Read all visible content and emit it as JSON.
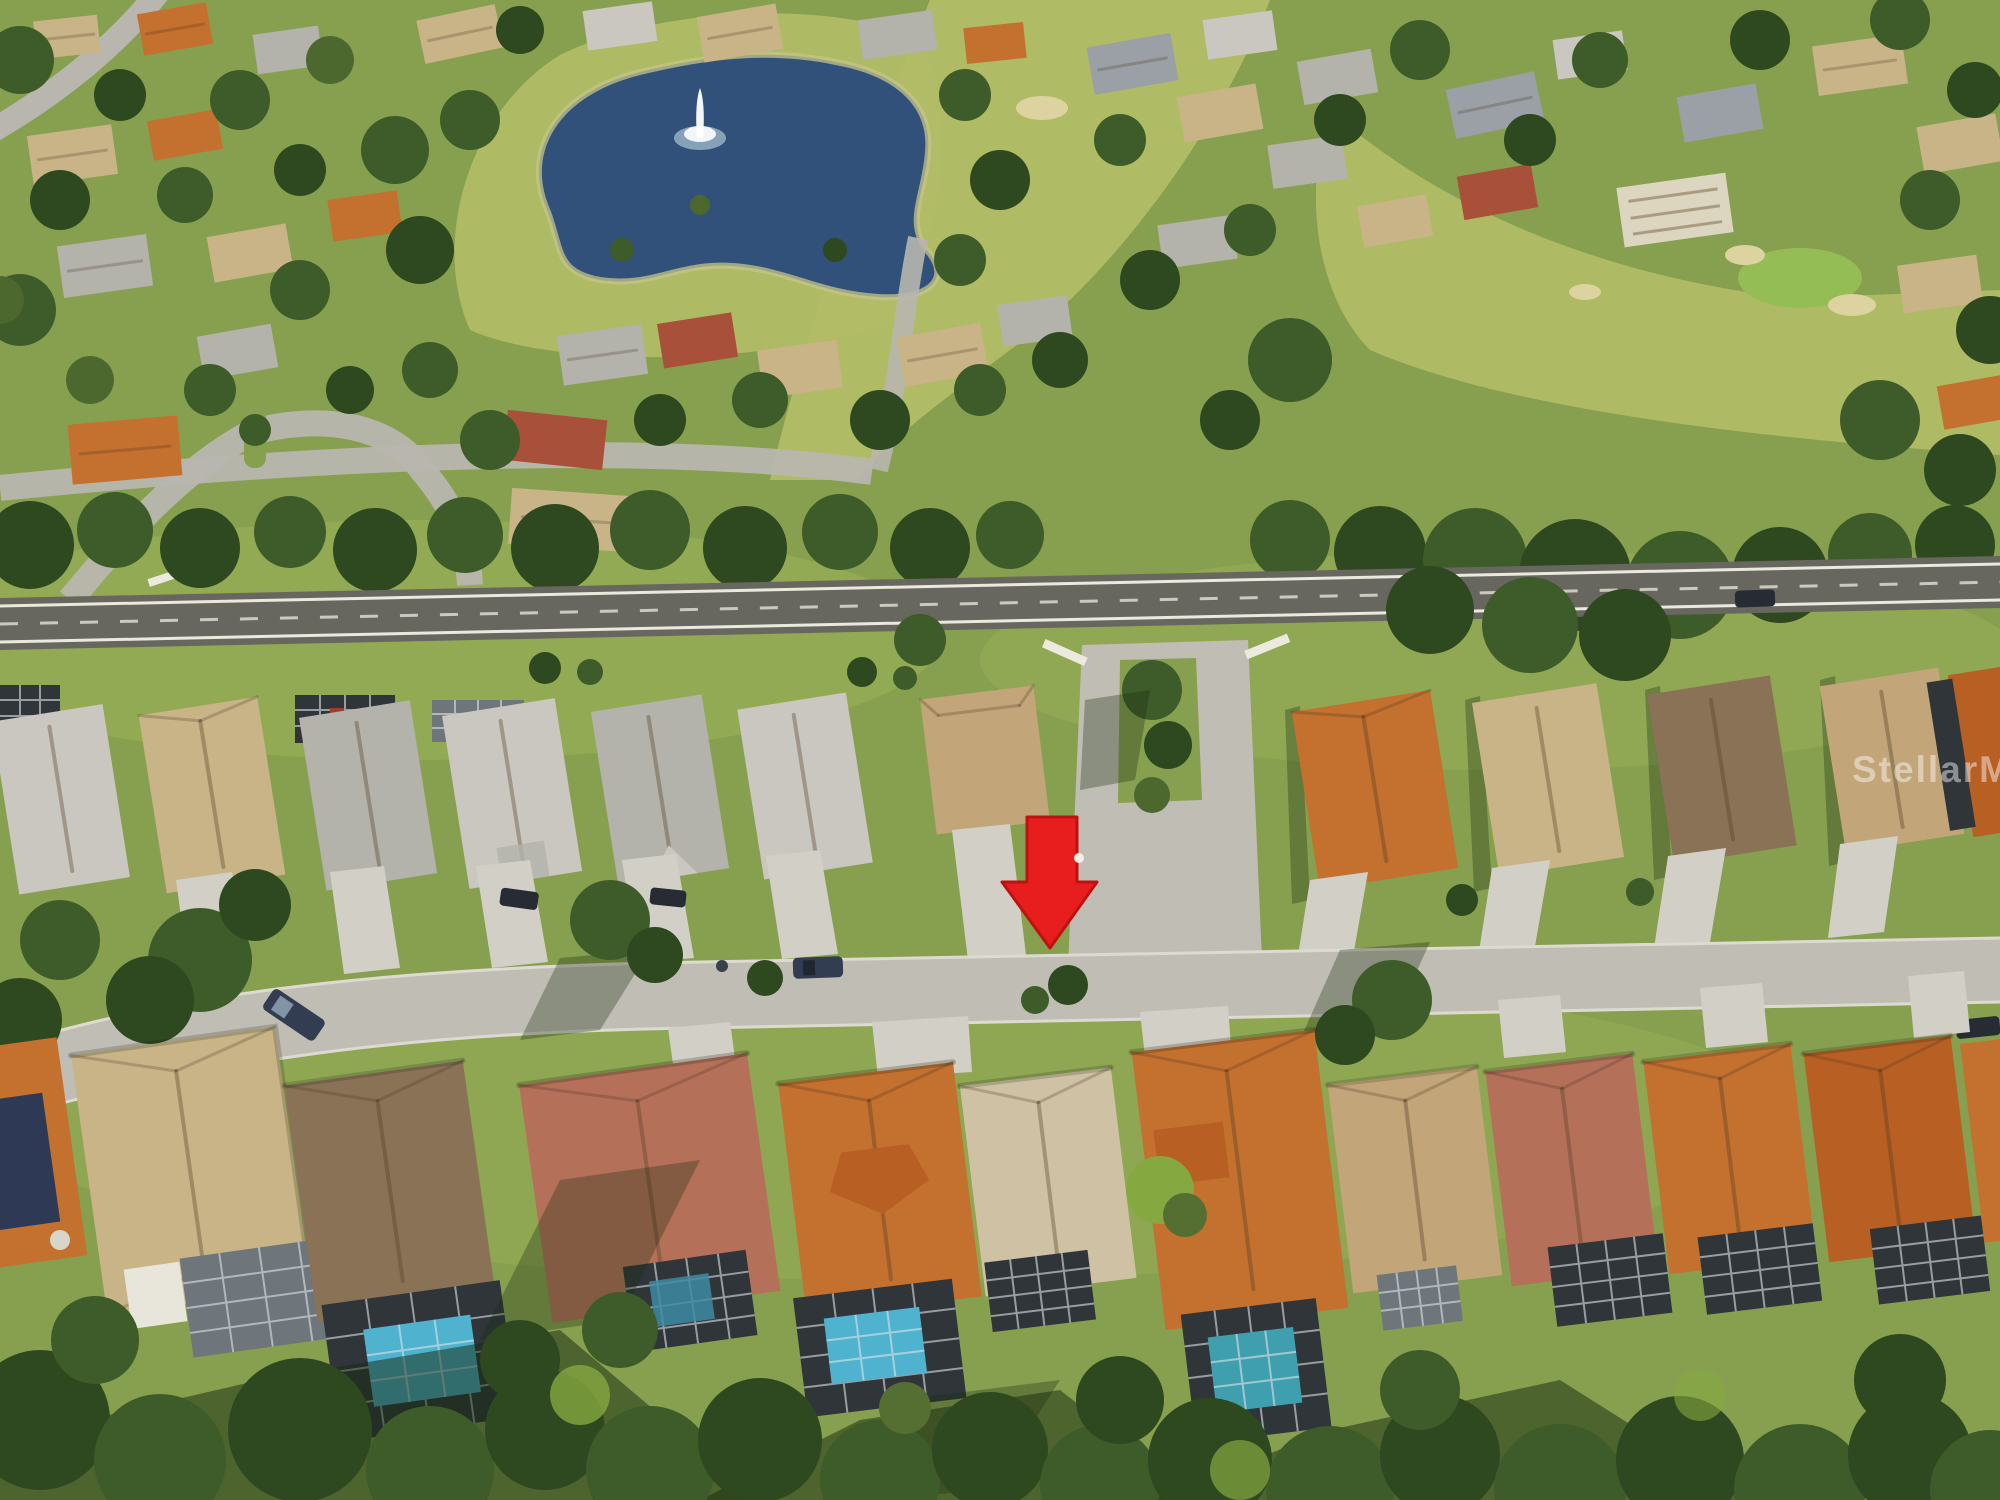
{
  "image": {
    "type": "aerial-photograph",
    "description": "Aerial drone photo of a Florida golf-course residential community; a red arrow marks a single-story home on the south side of a residential street",
    "width_px": 2000,
    "height_px": 1500
  },
  "watermark": {
    "text": "StellarMLS",
    "color": "#ffffff",
    "opacity": 0.45
  },
  "annotation": {
    "name": "red-location-arrow",
    "shape": "downward-arrow",
    "color": "#e81d1d",
    "outline": "#bf1111",
    "tip": {
      "x": 1050,
      "y": 948
    },
    "points_to": "cream-roof home behind the residential street"
  },
  "scene": {
    "setting": "master-planned golf community with pond, fairways, tree lines and tile-roof homes with screened pool enclosures",
    "features": [
      "pond-with-fountain",
      "golf-course-fairway",
      "putting-green",
      "sand-bunkers",
      "main-road",
      "community-entrance-median",
      "residential-street",
      "driveways",
      "screened-pool-enclosures",
      "swimming-pools",
      "solar-panels",
      "tree-shadows",
      "parked-cars"
    ],
    "colors": {
      "grass": "#87a04f",
      "fairway": "#b2bd66",
      "pond": "#31517a",
      "pond_edge": "#c6c489",
      "trees": "#3e5b2a",
      "main_road": "#67675f",
      "street": "#c0beb4",
      "driveway": "#d2cfc6",
      "roof_orange": "#c4702f",
      "roof_terracotta": "#b5705a",
      "roof_tan": "#c9b488",
      "roof_gray": "#b3b2ab",
      "roof_brown": "#8a7257",
      "roof_cream": "#cfc2a4",
      "pool_blue": "#4fb3cf",
      "pool_teal": "#3f9fae",
      "cage_dark": "#30353a",
      "fountain": "#ffffff"
    }
  }
}
